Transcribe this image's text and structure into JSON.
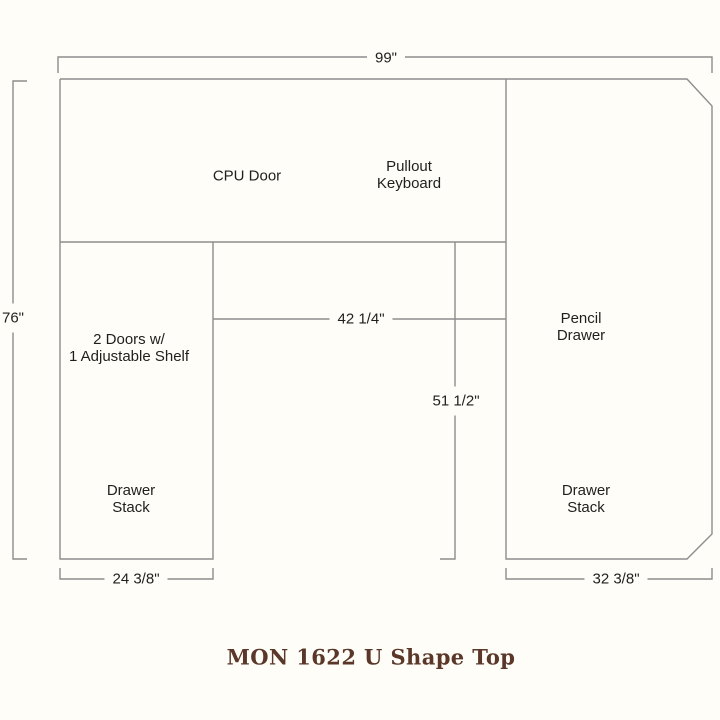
{
  "page": {
    "background": "#fffdf7"
  },
  "diagram": {
    "line_color": "#8d8d8d",
    "text_color": "#1f1f1f",
    "labels": {
      "cpu_door": "CPU Door",
      "pullout_keyboard": "Pullout\nKeyboard",
      "doors_shelf": "2 Doors w/\n1 Adjustable Shelf",
      "drawer_stack_left": "Drawer\nStack",
      "pencil_drawer": "Pencil\nDrawer",
      "drawer_stack_right": "Drawer\nStack"
    },
    "dimensions": {
      "overall_width": "99\"",
      "overall_depth": "76\"",
      "kneehole_width": "42 1/4\"",
      "kneehole_depth": "51 1/2\"",
      "left_pedestal_width": "24 3/8\"",
      "right_pedestal_width": "32 3/8\""
    }
  },
  "title": {
    "text": "MON 1622 U Shape Top",
    "color": "#5a3729"
  }
}
